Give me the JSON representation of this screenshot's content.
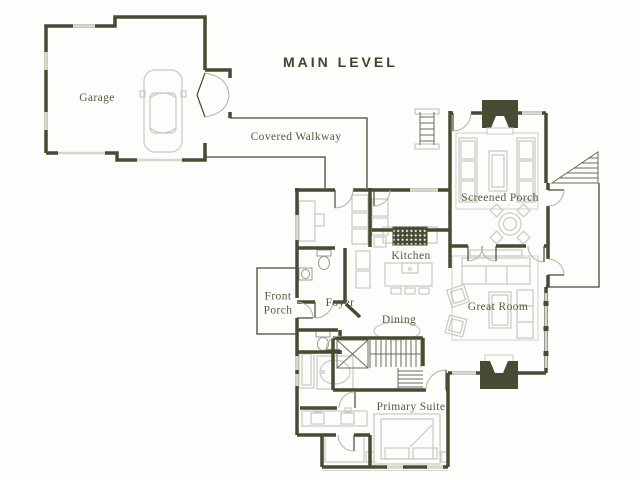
{
  "title": "MAIN LEVEL",
  "colors": {
    "wall": "#494a33",
    "window": "#d6d7cd",
    "furniture": "#c9cac1",
    "label_text": "#56583f",
    "title_text": "#41432f",
    "background": "#fdfdfb"
  },
  "labels": {
    "garage": "Garage",
    "covered_walkway": "Covered Walkway",
    "screened_porch": "Screened Porch",
    "kitchen": "Kitchen",
    "front_porch": "Front Porch",
    "foyer": "Foyer",
    "dining": "Dining",
    "great_room": "Great Room",
    "primary_suite": "Primary Suite"
  }
}
